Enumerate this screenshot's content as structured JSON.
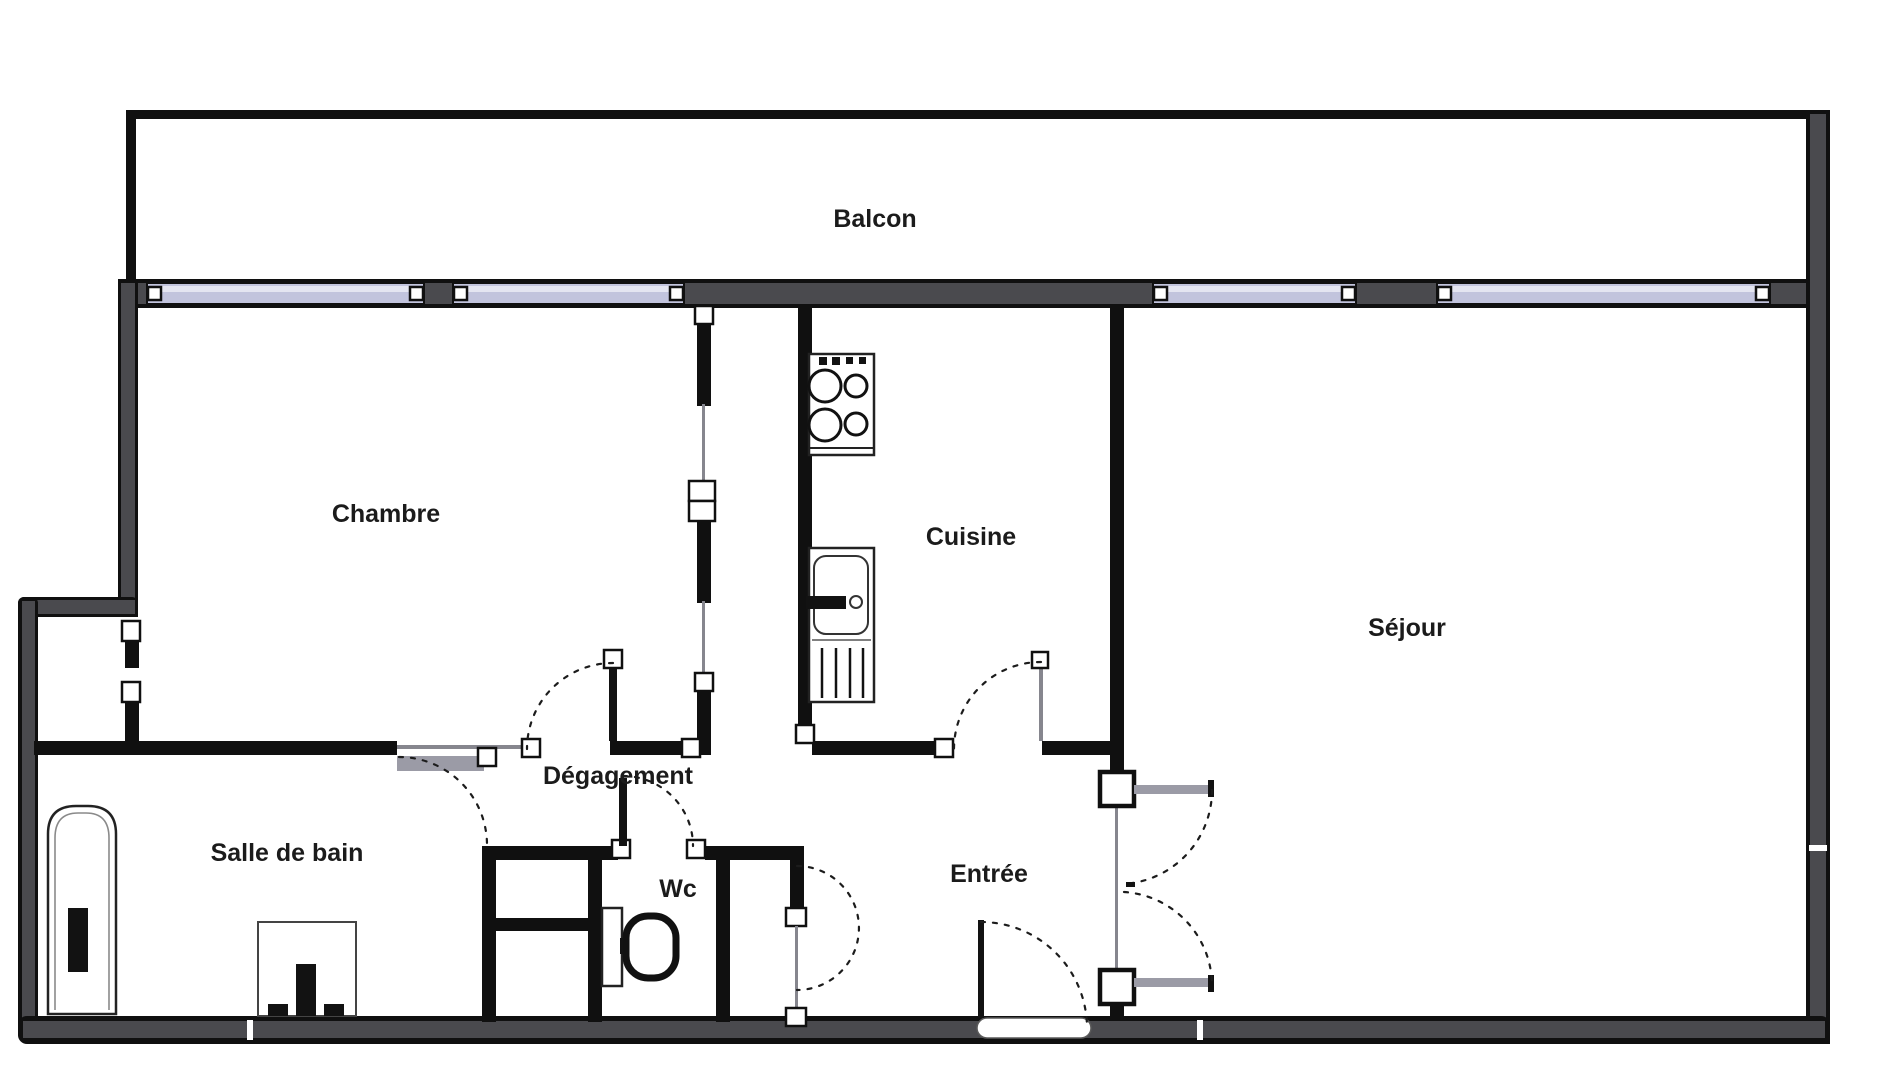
{
  "plan": {
    "rooms": {
      "balcon": {
        "label": "Balcon"
      },
      "chambre": {
        "label": "Chambre"
      },
      "cuisine": {
        "label": "Cuisine"
      },
      "sejour": {
        "label": "Séjour"
      },
      "salle_de_bain": {
        "label": "Salle de bain"
      },
      "degagement": {
        "label": "Dégagement"
      },
      "wc": {
        "label": "Wc"
      },
      "entree": {
        "label": "Entrée"
      }
    },
    "colors": {
      "wall_line": "#101010",
      "wall_fill": "#4a4a4e",
      "window_fill": "#c2c4dd",
      "window_highlight": "#e4e5f1",
      "paper": "#ffffff",
      "text_color": "#1b1b1b"
    }
  }
}
